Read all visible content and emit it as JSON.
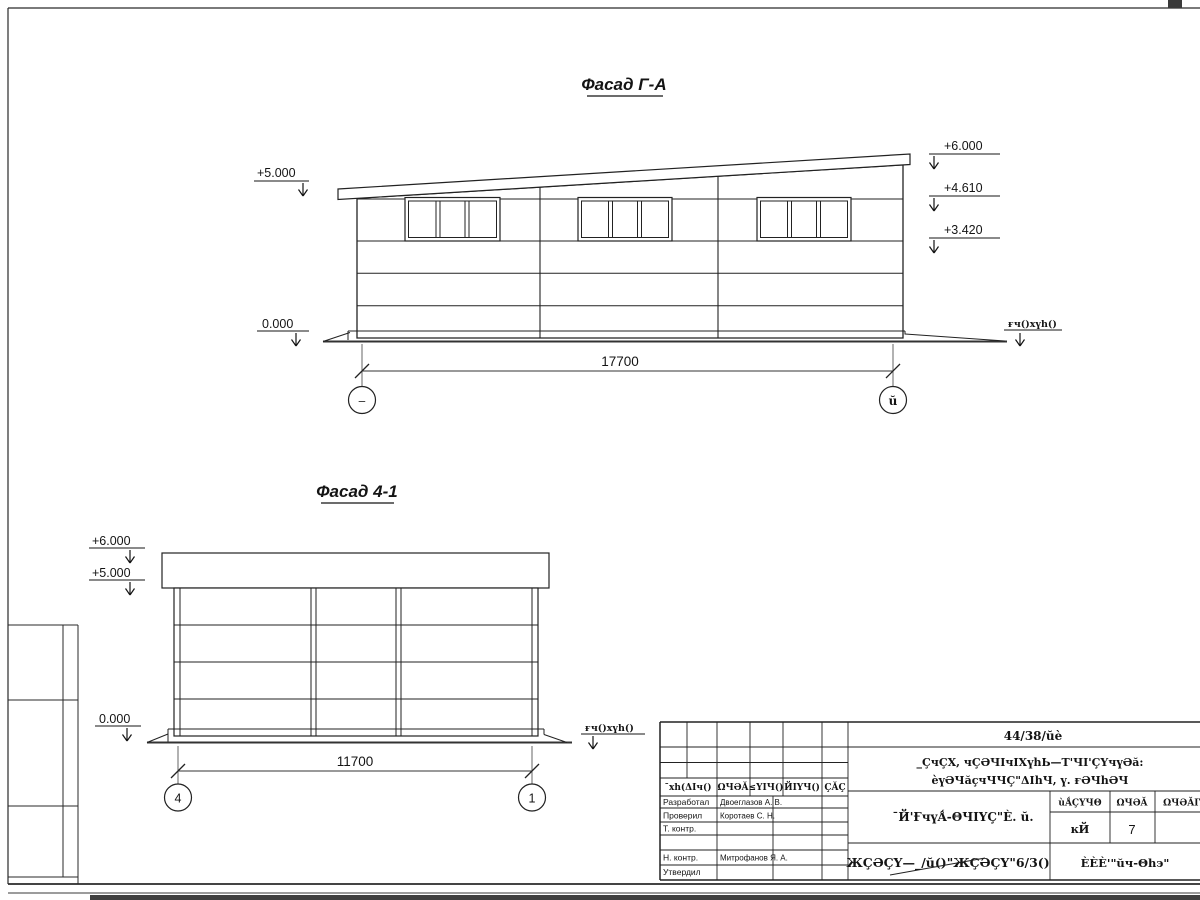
{
  "drawing1": {
    "title": "Фасад Г-А",
    "dim": "17700",
    "axis_left": "‒",
    "axis_right": "ŭ",
    "ground": "ғч()хүh()",
    "elev": {
      "left_top": "+5.000",
      "left_zero": "0.000",
      "r1": "+6.000",
      "r2": "+4.610",
      "r3": "+3.420"
    }
  },
  "drawing2": {
    "title": "Фасад 4-1",
    "dim": "11700",
    "axis_left": "4",
    "axis_right": "1",
    "ground": "ғч()хүh()",
    "elev": {
      "l1": "+6.000",
      "l2": "+5.000",
      "zero": "0.000"
    }
  },
  "stamp": {
    "code": "44/38/ŭè",
    "name1": "_ÇчÇХ, чÇƏЧΙчΙХүhЬ—Т'ЧΙ'ÇҮчүƏă:",
    "name2": "èүƏЧăçчЧЧÇ\"ΔΙhЧ, ү. ғƏЧhƏЧ",
    "cols": [
      "¯хh(ΔΙч()",
      "ΩЧƏĂ",
      "≤ΥΙЧ()",
      "ЙΙҮЧ()",
      "ÇĂÇ"
    ],
    "roles": [
      {
        "label": "Разработал",
        "name": "Двоеглазов А. В."
      },
      {
        "label": "Проверил",
        "name": "Коротаев С. Н."
      },
      {
        "label": "Т. контр.",
        "name": ""
      },
      {
        "label": "Н. контр.",
        "name": "Митрофанов Я. А."
      },
      {
        "label": "Утвердил",
        "name": ""
      }
    ],
    "drawing_title": "¯Й'ҒчүǺ-ΘЧΙҮÇ\"È. ŭ.",
    "stage": {
      "h1": "ùǺÇҮЧΘ",
      "h2": "ΩЧƏĂ",
      "h3": "ΩЧƏĂΙҮ",
      "v1": "ĸЙ",
      "v2": "7"
    },
    "doc": "ЖÇƏÇҮ—_/ŭ()\"ЖÇƏÇҮ\"6/3()",
    "company": "ÈÈÈ'\"ŭч-Θhэ\""
  }
}
